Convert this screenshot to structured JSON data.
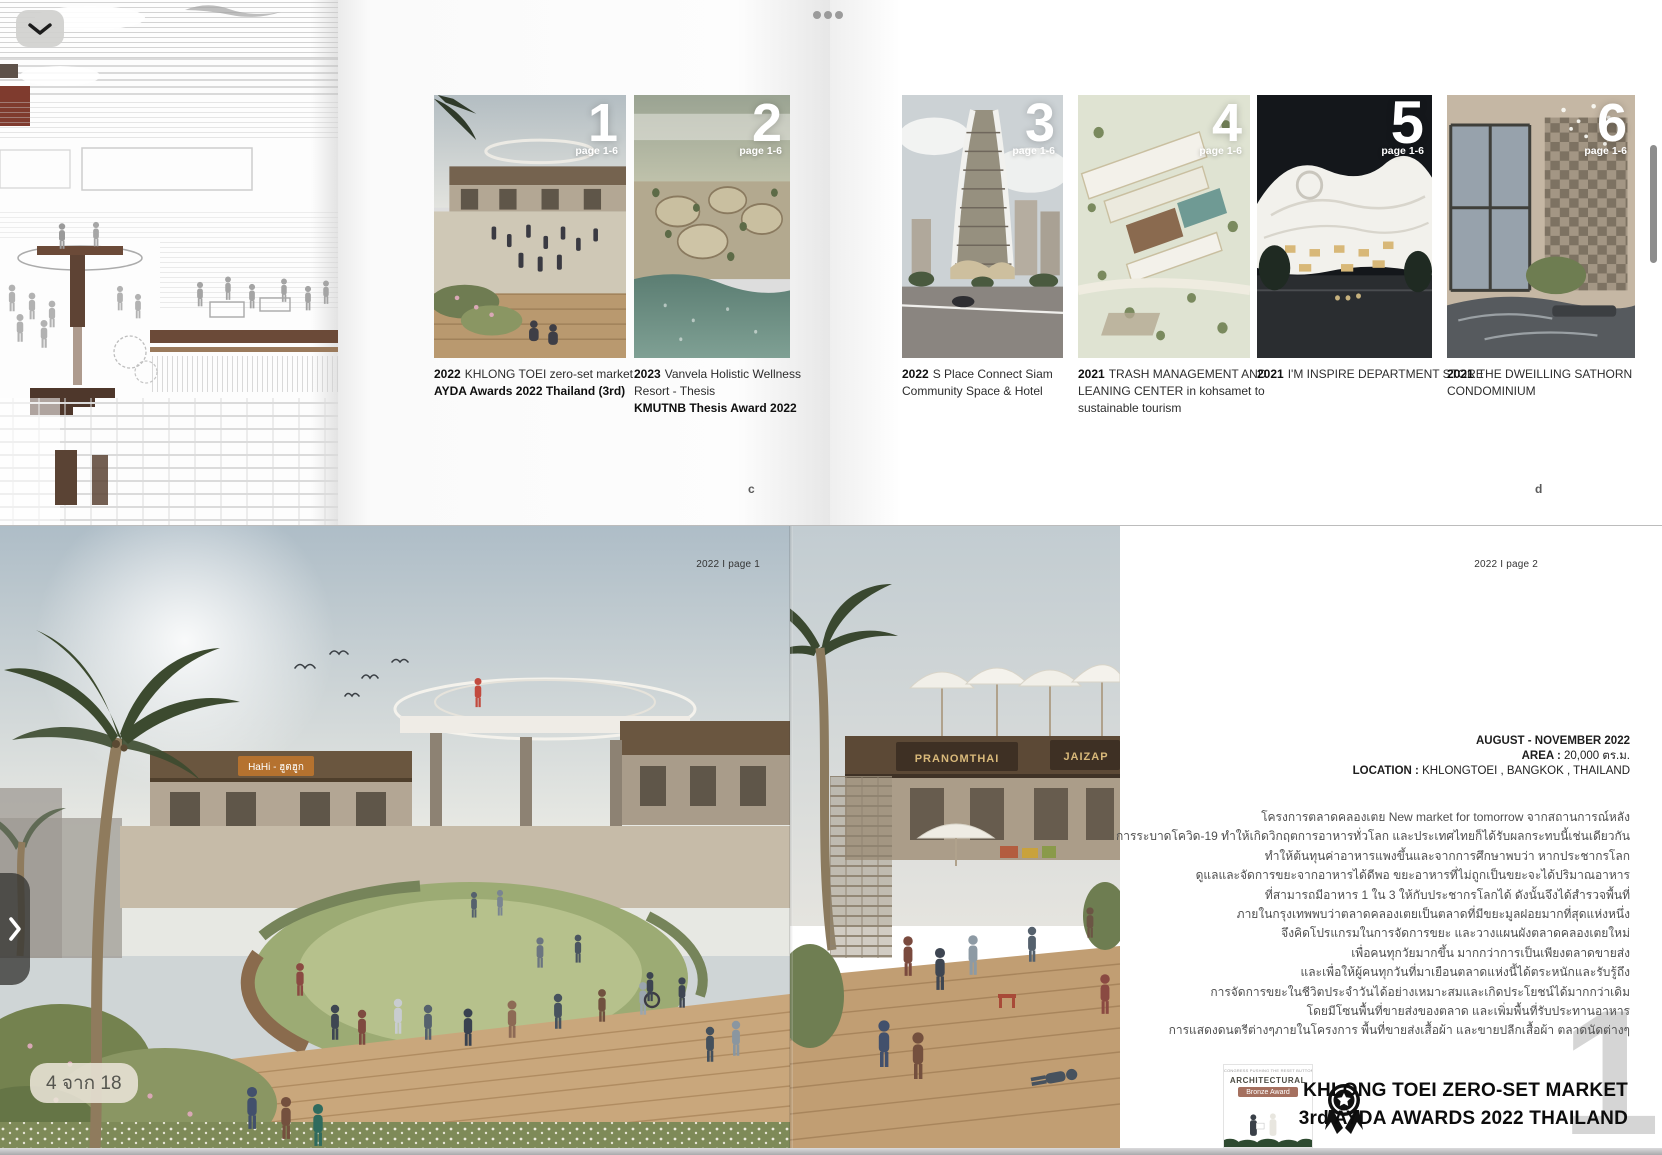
{
  "viewer": {
    "page_indicator": "4 จาก 18",
    "icons": {
      "collapse": "chevron-down-icon",
      "more": "more-options-dots",
      "next_page": "chevron-right-icon"
    }
  },
  "index": {
    "left_page_letter": "c",
    "right_page_letter": "d",
    "projects": [
      {
        "number": "1",
        "page_range": "page 1-6",
        "year": "2022",
        "line1": "KHLONG TOEI zero-set market",
        "award": "AYDA Awards 2022 Thailand (3rd)"
      },
      {
        "number": "2",
        "page_range": "page 1-6",
        "year": "2023",
        "line1": "Vanvela Holistic Wellness",
        "line2": "Resort - Thesis",
        "award": "KMUTNB Thesis Award 2022"
      },
      {
        "number": "3",
        "page_range": "page 1-6",
        "year": "2022",
        "line1": "S Place Connect Siam",
        "line2": "Community Space & Hotel"
      },
      {
        "number": "4",
        "page_range": "page 1-6",
        "year": "2021",
        "line1": "TRASH MANAGEMENT AND",
        "line2": "LEANING CENTER in kohsamet to",
        "line3": "sustainable tourism"
      },
      {
        "number": "5",
        "page_range": "page 1-6",
        "year": "2021",
        "line1": "I'M INSPIRE DEPARTMENT STORE"
      },
      {
        "number": "6",
        "page_range": "page 1-6",
        "year": "2021",
        "line1": "THE DWEILLING SATHORN",
        "line2": "CONDOMINIUM"
      }
    ]
  },
  "detail": {
    "page1_label": "2022 I page 1",
    "page2_label": "2022 I page 2",
    "sign_hahi": "HaHi - ฮูตฮูก",
    "sign_pranomthai": "PRANOMTHAI",
    "sign_jaizap": "JAIZAP",
    "info": {
      "dates": "AUGUST - NOVEMBER 2022",
      "area_label": "AREA :",
      "area_value": "20,000 ตร.ม.",
      "location_label": "LOCATION :",
      "location_value": "KHLONGTOEI , BANGKOK , THAILAND"
    },
    "paragraph_lines": [
      "โครงการตลาดคลองเตย New market for tomorrow จากสถานการณ์หลัง",
      "การระบาดโควิด-19 ทำให้เกิดวิกฤตการอาหารทั่วโลก และประเทศไทยก็ได้รับผลกระทบนี้เช่นเดียวกัน",
      "ทำให้ต้นทุนค่าอาหารแพงขึ้นและจากการศึกษาพบว่า หากประชากรโลก",
      "ดูแลและจัดการขยะจากอาหารได้ดีพอ ขยะอาหารที่ไม่ถูกเป็นขยะจะได้ปริมาณอาหาร",
      "ที่สามารถมีอาหาร 1 ใน 3 ให้กับประชากรโลกได้ ดังนั้นจึงได้สำรวจพื้นที่",
      "ภายในกรุงเทพพบว่าตลาดคลองเตยเป็นตลาดที่มีขยะมูลฝอยมากที่สุดแห่งหนึ่ง",
      "จึงคิดโปรแกรมในการจัดการขยะ และวางแผนผังตลาดคลองเตยใหม่",
      "เพื่อคนทุกวัยมากขึ้น มากกว่าการเป็นเพียงตลาดขายส่ง",
      "และเพื่อให้ผู้คนทุกวันที่มาเยือนตลาดแห่งนี้ได้ตระหนักและรับรู้ถึง",
      "การจัดการขยะในชีวิตประจำวันได้อย่างเหมาะสมและเกิดประโยชน์ได้มากกว่าเดิม",
      "โดยมีโซนพื้นที่ขายส่งของตลาด และเพิ่มพื้นที่รับประทานอาหาร",
      "การแสดงดนตรีต่างๆภายในโครงการ พื้นที่ขายส่งเสื้อผ้า และขายปลีกเสื้อผ้า ตลาดนัดต่างๆ"
    ],
    "award": {
      "photo_header": "CONGRESS PUSHING THE RESET BUTTON",
      "photo_title": "ARCHITECTURAL",
      "photo_badge": "Bronze Award",
      "line1": "KHLONG TOEI  ZERO-SET MARKET",
      "line2": "3rd AYDA AWARDS 2022 THAILAND",
      "big_number": "1"
    }
  }
}
